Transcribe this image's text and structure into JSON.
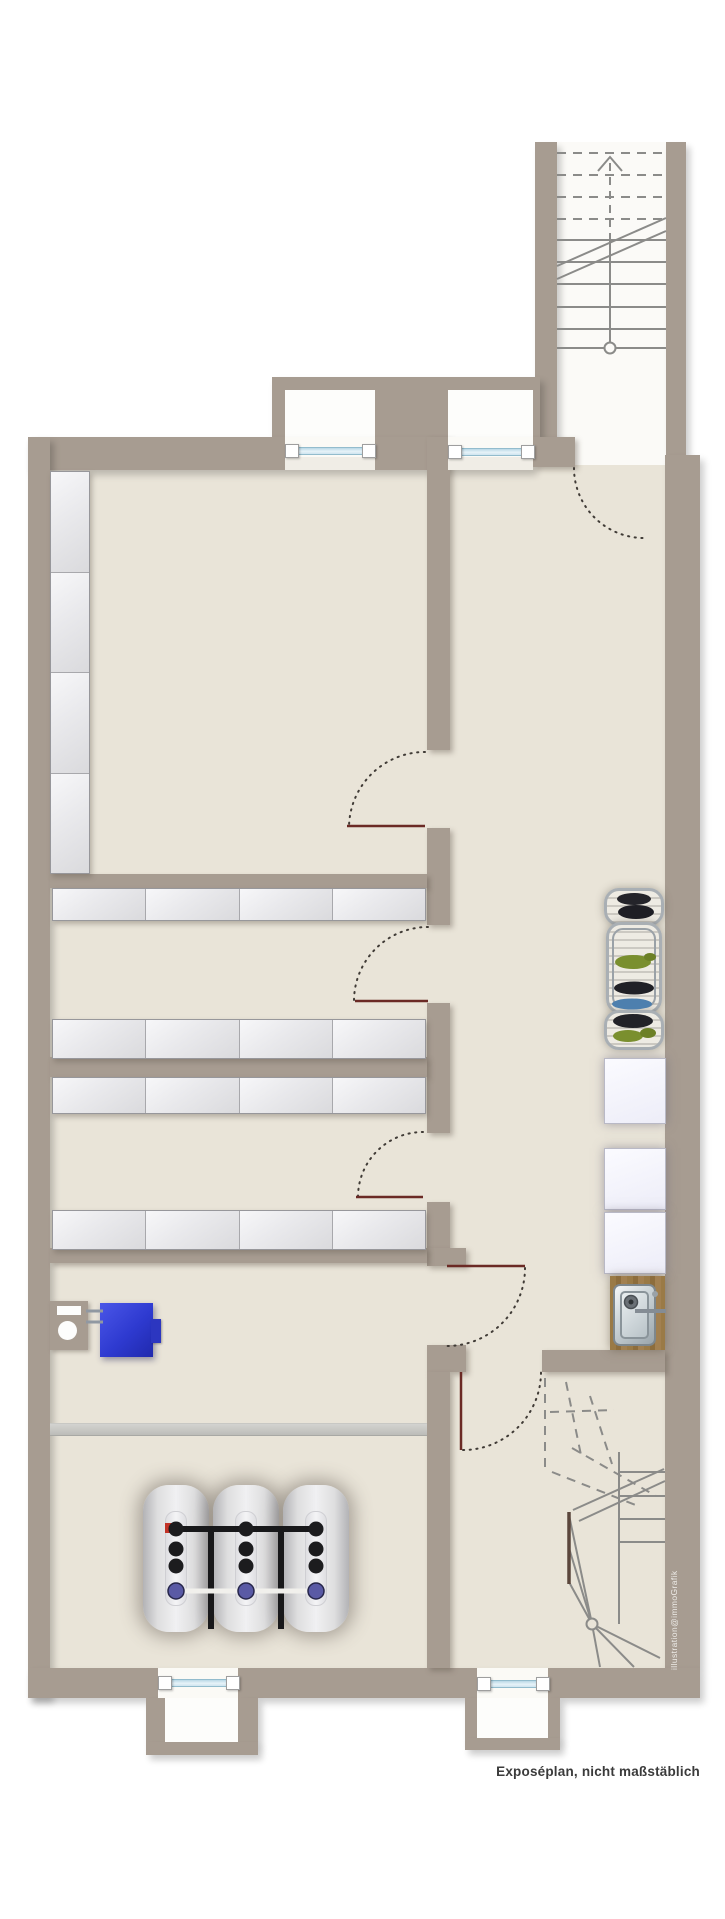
{
  "document": {
    "caption": "Exposéplan, nicht maßstäblich",
    "watermark": "illustration@immoGrafik",
    "kind": "basement floor plan (Kellergeschoss), top-down architectural exposé drawing"
  },
  "colors": {
    "wall": "#a79c91",
    "floor": "#e9e4d8",
    "outside": "#ffffff",
    "stair_interior": "#fbfaf7",
    "door_leaf": "#6b2a25",
    "door_swing_dots": "#403b36",
    "stair_line": "#8b8b89",
    "window_glass": "#cfe5ef",
    "shelf": "#ececef",
    "tank_body": "#e2e2e4",
    "tank_pipe_black": "#1c1c1e",
    "tank_pipe_white": "#f1f0ec",
    "tank_connector_blue": "#5a5aa5",
    "tank_connector_red": "#c23327",
    "boiler_blue": "#3340d6",
    "pipe_gray": "#c6c6c3",
    "counter_wood": "#96743f",
    "caption_text": "#3b3b3b",
    "watermark_text": "#edebe7"
  },
  "inventory": {
    "staircases": [
      {
        "id": "upper-right",
        "style": "straight run",
        "solid_treads": 6,
        "dashed_treads": 4,
        "has_newel_circle": true,
        "has_up_arrow": true,
        "has_handrail": true
      },
      {
        "id": "lower-right",
        "style": "winder",
        "solid_treads": 4,
        "fan_treads": 6,
        "dashed_upper_flight": true,
        "has_newel_circle": true
      }
    ],
    "windows": [
      {
        "location": "top wall, left light-well"
      },
      {
        "location": "top wall, right light-well"
      },
      {
        "location": "bottom wall, left light-well"
      },
      {
        "location": "bottom wall, right light-well"
      }
    ],
    "doors": [
      {
        "id": "A",
        "into": "storage compartment 1"
      },
      {
        "id": "B",
        "into": "storage compartment 2"
      },
      {
        "id": "C",
        "into": "storage compartment 3"
      },
      {
        "id": "D",
        "into": "tank / boiler room"
      },
      {
        "id": "E",
        "into": "lower stair room"
      },
      {
        "id": "F",
        "into": "hallway at upper stair foot"
      }
    ],
    "storage": {
      "vertical_shelf_segments": 4,
      "shelf_rows": 4,
      "segments_per_row": 4
    },
    "heating": {
      "oil_tanks": 3,
      "tank_top_connectors_per_tank": 3,
      "tank_bottom_connector_color": "blue-violet",
      "boiler": "blue wall unit with flue fixture",
      "pipe_run": 1
    },
    "laundry": {
      "drying_racks": 3,
      "white_appliances": 3,
      "sink_with_wood_counter": 1
    }
  }
}
